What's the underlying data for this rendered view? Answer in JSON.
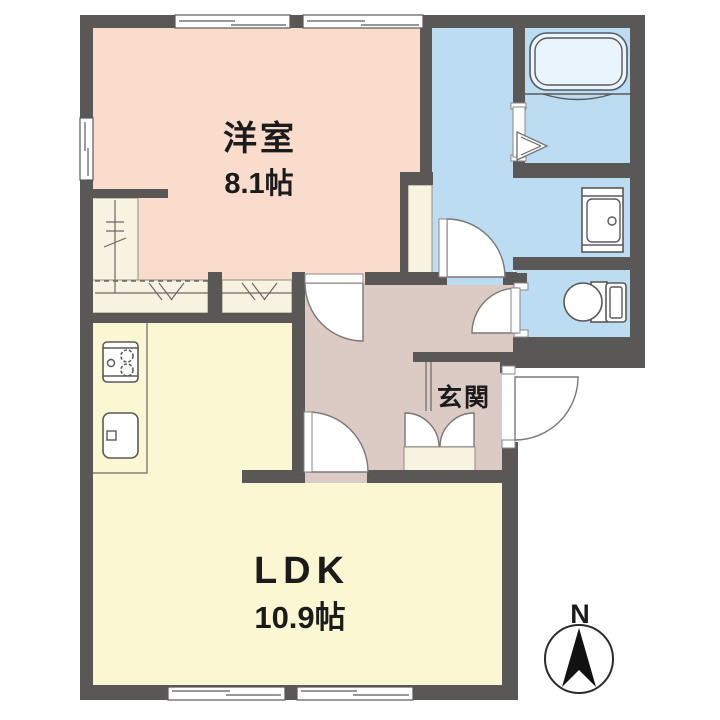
{
  "rooms": {
    "west_room": {
      "label": "洋室",
      "area": "8.1帖"
    },
    "ldk": {
      "label": "LDK",
      "area": "10.9帖"
    },
    "entrance": {
      "label": "玄関"
    }
  },
  "compass": {
    "north_label": "N"
  },
  "colors": {
    "wall": "#5a5757",
    "west_room_floor": "#f9dccb",
    "ldk_floor": "#fbf7d3",
    "hall_floor": "#dccac4",
    "wet_area_floor": "#bcdcf2",
    "closet_floor": "#f8f3e1"
  },
  "fixtures": {
    "bathtub": "bathtub-icon",
    "washbasin": "washbasin-icon",
    "toilet": "toilet-icon",
    "stove": "stove-icon",
    "kitchen_sink": "kitchen-sink-icon",
    "shoe_cabinet": "shoe-cabinet",
    "closet_hanger": "hanger-pipe",
    "north_arrow": "north-arrow-icon"
  }
}
